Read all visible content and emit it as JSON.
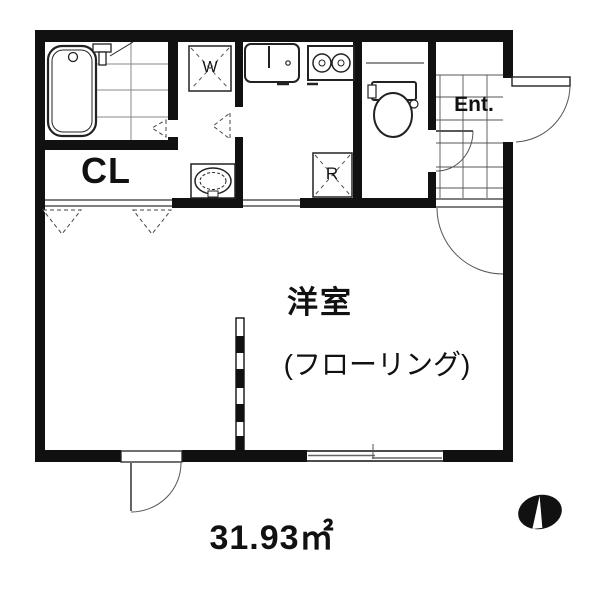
{
  "plan": {
    "area_label": "31.93㎡",
    "main_room": {
      "name": "洋室",
      "floor_type": "(フローリング)"
    },
    "closet_label": "CL",
    "washer_label": "W",
    "fridge_label": "R",
    "entrance_label": "Ent.",
    "colors": {
      "wall": "#111111",
      "background": "#ffffff",
      "fixture_line": "#222222",
      "tile_grid_line": "#777777"
    },
    "icons": {
      "north_indicator": "black-ellipse-with-white-needle"
    }
  }
}
